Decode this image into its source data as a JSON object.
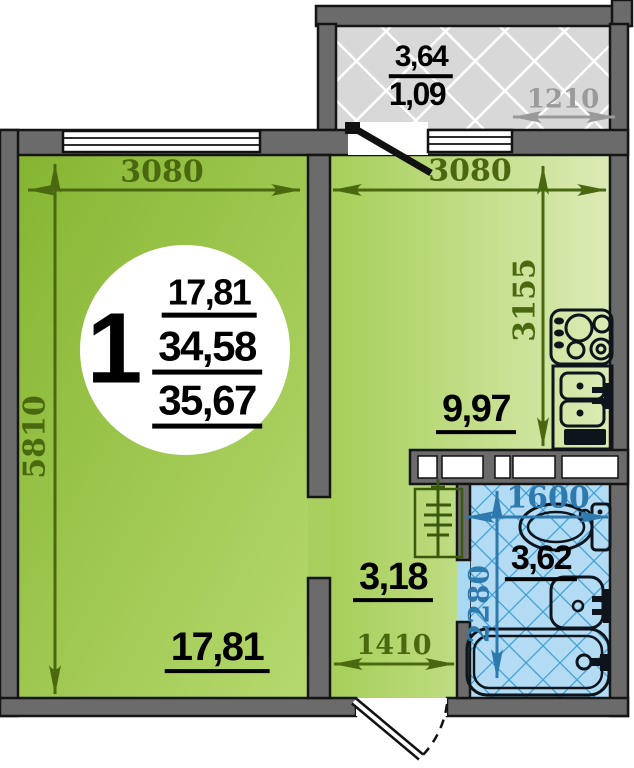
{
  "unit": {
    "number": "1",
    "living_area": "17,81",
    "total_area": "34,58",
    "total_area_with_balcony": "35,67"
  },
  "rooms": {
    "balcony": {
      "area": "3,64",
      "area_reduced": "1,09",
      "width_mm": "1210"
    },
    "living_room": {
      "area": "17,81",
      "width_mm": "3080",
      "depth_mm": "5810"
    },
    "kitchen": {
      "area": "9,97",
      "width_mm": "3080",
      "depth_mm": "3155"
    },
    "hallway": {
      "area": "3,18",
      "width_mm": "1410"
    },
    "bathroom": {
      "area": "3,62",
      "width_mm": "1600",
      "depth_mm": "2280"
    }
  },
  "icons": {
    "stove": "stove-icon",
    "kitchen_sink": "kitchen-sink-icon",
    "toilet": "toilet-icon",
    "washbasin": "washbasin-icon",
    "bathtub": "bathtub-icon",
    "heating_riser": "heating-riser-icon",
    "entrance_door": "entrance-door-icon",
    "balcony_door": "balcony-door-icon",
    "window": "window-icon"
  },
  "colors": {
    "wall": "#6b6b6b",
    "living_green_dark": "#85b531",
    "living_green_light": "#b6d96e",
    "kitchen_green_light": "#dcebb6",
    "bathroom_blue": "#b3dcf4",
    "bathroom_hatch_blue": "#3f9dd3",
    "balcony_gray": "#d8d8d8",
    "dim_olive": "#4a680f",
    "dim_blue": "#2e79ad",
    "dim_gray": "#9a9a9a"
  }
}
